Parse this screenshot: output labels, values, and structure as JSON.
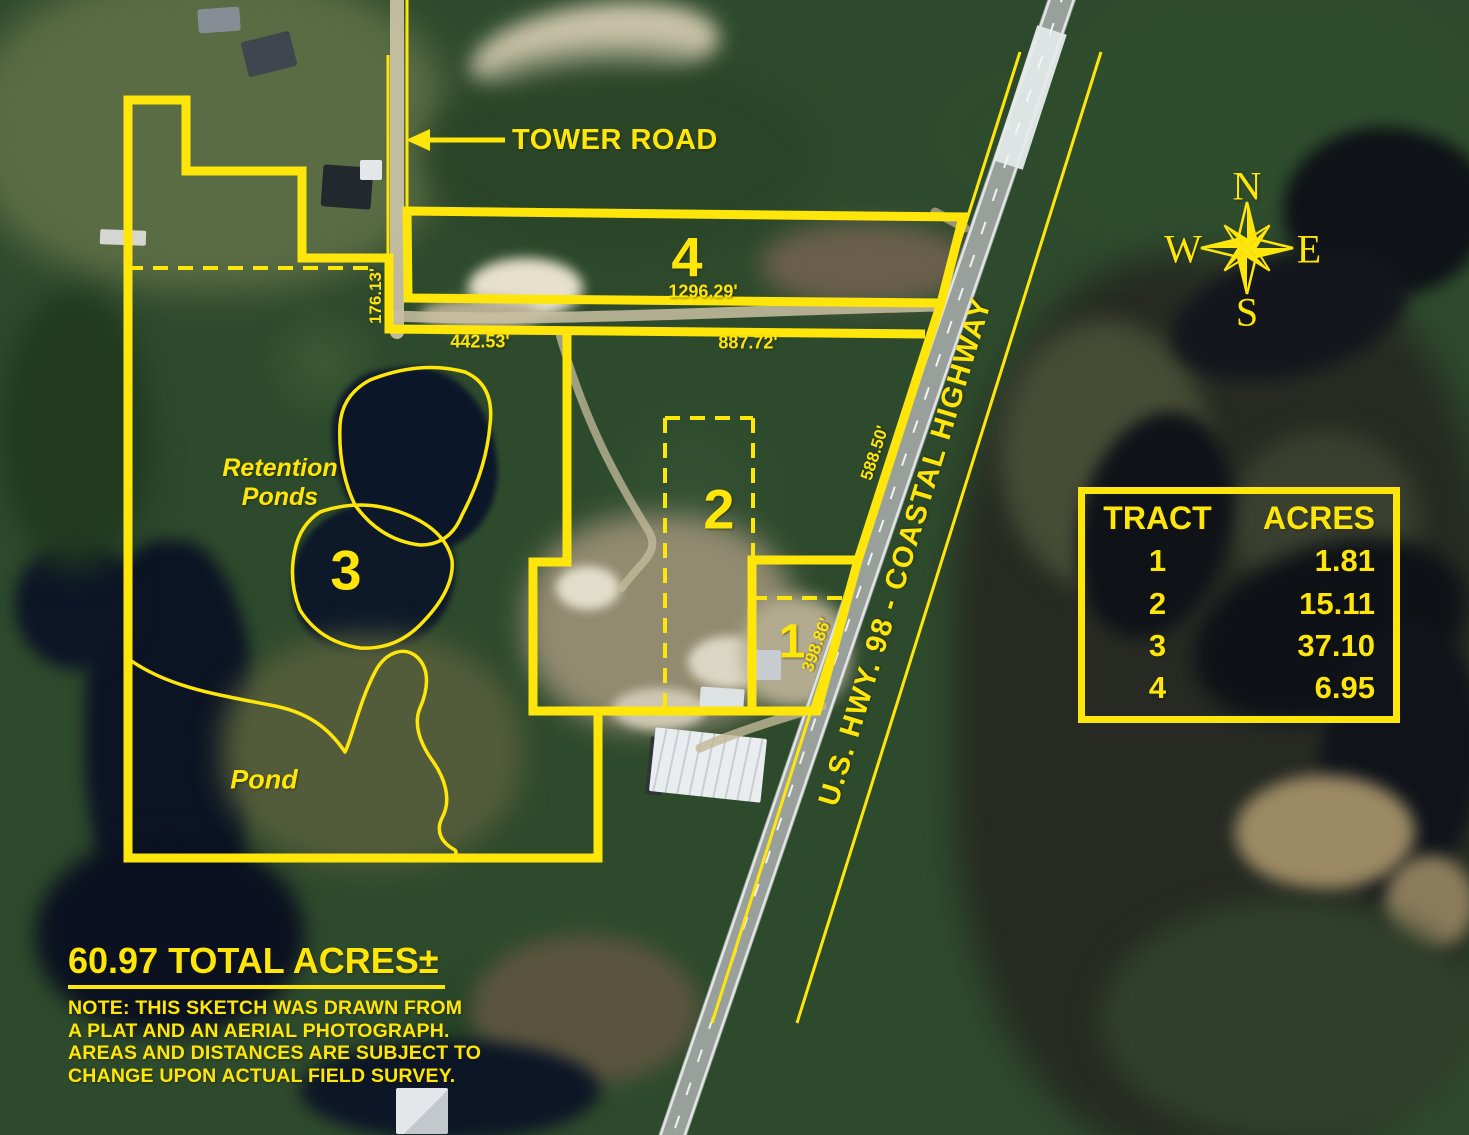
{
  "title_block": {
    "total_acres": "60.97 TOTAL ACRES±",
    "note_lines": [
      "NOTE: THIS SKETCH WAS DRAWN FROM",
      "A PLAT AND AN AERIAL PHOTOGRAPH.",
      "AREAS AND DISTANCES ARE SUBJECT TO",
      "CHANGE UPON ACTUAL FIELD SURVEY."
    ]
  },
  "acres_table": {
    "header": {
      "tract": "TRACT",
      "acres": "ACRES"
    },
    "rows": [
      {
        "tract": "1",
        "acres": "1.81"
      },
      {
        "tract": "2",
        "acres": "15.11"
      },
      {
        "tract": "3",
        "acres": "37.10"
      },
      {
        "tract": "4",
        "acres": "6.95"
      }
    ]
  },
  "road_labels": {
    "tower_road": "TOWER ROAD",
    "highway": "U.S. HWY. 98 - COASTAL HIGHWAY"
  },
  "feature_labels": {
    "retention_line1": "Retention",
    "retention_line2": "Ponds",
    "pond": "Pond"
  },
  "measurements": {
    "tower_frontage": "176.13'",
    "tract3_north": "442.53'",
    "tract2_north": "887.72'",
    "tract4_south": "1296.29'",
    "tract2_east": "588.50'",
    "tract1_east": "398.86'"
  },
  "compass": {
    "north": "N",
    "east": "E",
    "south": "S",
    "west": "W"
  },
  "colors": {
    "annotation_yellow": "#ffe60a"
  }
}
